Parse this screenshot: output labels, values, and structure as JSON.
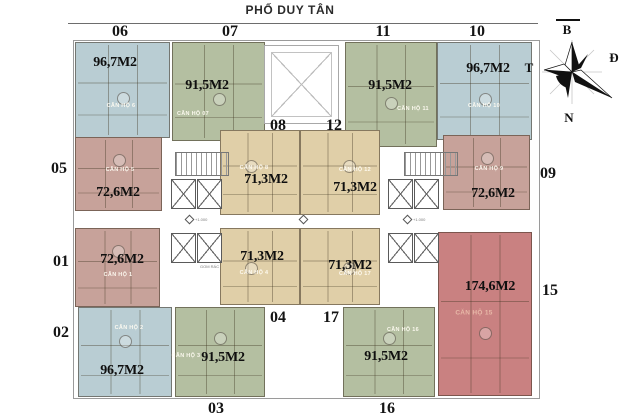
{
  "title": "PHỐ DUY TÂN",
  "compass": {
    "north_label": "B",
    "east_label": "Đ",
    "south_label": "N",
    "west_label": "T"
  },
  "colors": {
    "blue": "#b9cdd3",
    "green": "#b4bfa1",
    "pink": "#c7a29a",
    "tan": "#e0cfa8",
    "red": "#c98181"
  },
  "core": {
    "trash_label": "GOM RÁC",
    "level_label": "+1.000"
  },
  "units": [
    {
      "no": "01",
      "name": "CĂN HỘ 1",
      "area": "72,6M2",
      "color_key": "pink"
    },
    {
      "no": "02",
      "name": "CĂN HỘ 2",
      "area": "96,7M2",
      "color_key": "blue"
    },
    {
      "no": "03",
      "name": "CĂN HỘ 3",
      "area": "91,5M2",
      "color_key": "green"
    },
    {
      "no": "04",
      "name": "CĂN HỘ 4",
      "area": "71,3M2",
      "color_key": "tan"
    },
    {
      "no": "05",
      "name": "CĂN HỘ 5",
      "area": "72,6M2",
      "color_key": "pink"
    },
    {
      "no": "06",
      "name": "CĂN HỘ 6",
      "area": "96,7M2",
      "color_key": "blue"
    },
    {
      "no": "07",
      "name": "CĂN HỘ 07",
      "area": "91,5M2",
      "color_key": "green"
    },
    {
      "no": "08",
      "name": "CĂN HỘ 8",
      "area": "71,3M2",
      "color_key": "tan"
    },
    {
      "no": "09",
      "name": "CĂN HỘ 9",
      "area": "72,6M2",
      "color_key": "pink"
    },
    {
      "no": "10",
      "name": "CĂN HỘ 10",
      "area": "96,7M2",
      "color_key": "blue"
    },
    {
      "no": "11",
      "name": "CĂN HỘ 11",
      "area": "91,5M2",
      "color_key": "green"
    },
    {
      "no": "12",
      "name": "CĂN HỘ 12",
      "area": "71,3M2",
      "color_key": "tan"
    },
    {
      "no": "15",
      "name": "CĂN HỘ 15",
      "area": "174,6M2",
      "color_key": "red"
    },
    {
      "no": "16",
      "name": "CĂN HỘ 16",
      "area": "91,5M2",
      "color_key": "green"
    },
    {
      "no": "17",
      "name": "CĂN HỘ 17",
      "area": "71,3M2",
      "color_key": "tan"
    }
  ]
}
